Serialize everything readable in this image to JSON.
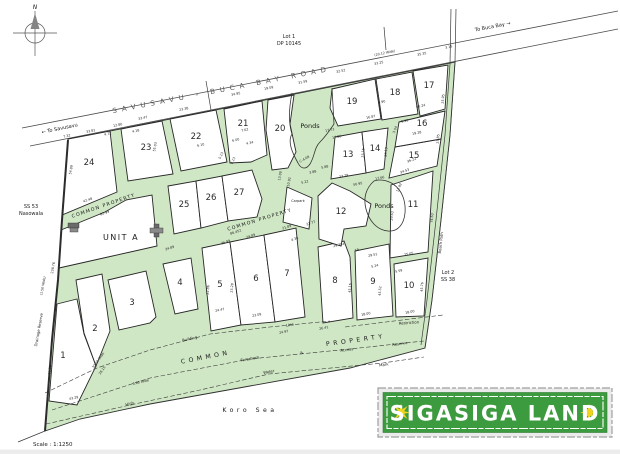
{
  "plan": {
    "title": "SIGASIGA LAND",
    "scale_label": "Scale : 1:1250",
    "north_label": "N",
    "sea_label": "Koro Sea"
  },
  "road": {
    "name": "SAVUSAVU - BUCA BAY ROAD",
    "width_note": "(20.12 Wide)",
    "to_west": "← To Savusavu",
    "to_east": "To Buca Bay →"
  },
  "adjacent": {
    "north_lot": [
      "Lot 1",
      "DP 10145"
    ],
    "west_lot": [
      "SS 53",
      "Nasowala"
    ],
    "southeast_lot": [
      "Lot 2",
      "SS 38"
    ]
  },
  "colors": {
    "land_green": "#cfe7c4",
    "logo_green": "#3d9b3f",
    "logo_star": "#f2d41c",
    "line_dark": "#222222"
  },
  "lots": [
    {
      "n": "1",
      "x": 63,
      "y": 358
    },
    {
      "n": "2",
      "x": 95,
      "y": 331
    },
    {
      "n": "3",
      "x": 132,
      "y": 305
    },
    {
      "n": "4",
      "x": 180,
      "y": 285
    },
    {
      "n": "5",
      "x": 220,
      "y": 287
    },
    {
      "n": "6",
      "x": 256,
      "y": 281
    },
    {
      "n": "7",
      "x": 287,
      "y": 276
    },
    {
      "n": "8",
      "x": 335,
      "y": 283
    },
    {
      "n": "9",
      "x": 373,
      "y": 284
    },
    {
      "n": "10",
      "x": 409,
      "y": 288
    },
    {
      "n": "11",
      "x": 413,
      "y": 207
    },
    {
      "n": "12",
      "x": 341,
      "y": 214
    },
    {
      "n": "13",
      "x": 348,
      "y": 157
    },
    {
      "n": "14",
      "x": 375,
      "y": 151
    },
    {
      "n": "15",
      "x": 414,
      "y": 158
    },
    {
      "n": "16",
      "x": 422,
      "y": 126
    },
    {
      "n": "17",
      "x": 429,
      "y": 88
    },
    {
      "n": "18",
      "x": 395,
      "y": 95
    },
    {
      "n": "19",
      "x": 352,
      "y": 104
    },
    {
      "n": "20",
      "x": 280,
      "y": 131
    },
    {
      "n": "21",
      "x": 243,
      "y": 126
    },
    {
      "n": "22",
      "x": 196,
      "y": 139
    },
    {
      "n": "23",
      "x": 146,
      "y": 150
    },
    {
      "n": "24",
      "x": 89,
      "y": 165
    },
    {
      "n": "25",
      "x": 184,
      "y": 207
    },
    {
      "n": "26",
      "x": 211,
      "y": 200
    },
    {
      "n": "27",
      "x": 239,
      "y": 195
    }
  ],
  "labels": [
    {
      "t": "SAVUSAVU - BUCA BAY ROAD",
      "x": 222,
      "y": 92,
      "r": -11,
      "c": "road"
    },
    {
      "t": "← To Savusavu",
      "x": 60,
      "y": 130,
      "r": -12,
      "c": "small"
    },
    {
      "t": "To Buca Bay →",
      "x": 493,
      "y": 28,
      "r": -11,
      "c": "small"
    },
    {
      "t": "Lot 1",
      "x": 289,
      "y": 38,
      "r": 0,
      "c": "small"
    },
    {
      "t": "DP 10145",
      "x": 289,
      "y": 45,
      "r": 0,
      "c": "small"
    },
    {
      "t": "SS 53",
      "x": 31,
      "y": 208,
      "r": 0,
      "c": "small"
    },
    {
      "t": "Nasowala",
      "x": 31,
      "y": 215,
      "r": 0,
      "c": "small"
    },
    {
      "t": "Lot 2",
      "x": 448,
      "y": 274,
      "r": 0,
      "c": "small"
    },
    {
      "t": "SS 38",
      "x": 448,
      "y": 281,
      "r": 0,
      "c": "small"
    },
    {
      "t": "UNIT A",
      "x": 121,
      "y": 240,
      "r": 0,
      "c": "unit"
    },
    {
      "t": "Ponds",
      "x": 310,
      "y": 128,
      "r": 0,
      "c": "ponds"
    },
    {
      "t": "Ponds",
      "x": 384,
      "y": 208,
      "r": 0,
      "c": "ponds"
    },
    {
      "t": "Carpark",
      "x": 298,
      "y": 202,
      "r": 0,
      "c": "micro"
    },
    {
      "t": "COMMON PROPERTY",
      "x": 104,
      "y": 207,
      "r": -19,
      "c": "cp"
    },
    {
      "t": "COMMON PROPERTY",
      "x": 260,
      "y": 221,
      "r": -17,
      "c": "cp"
    },
    {
      "t": "COMMON",
      "x": 206,
      "y": 359,
      "r": -11,
      "c": "cpband"
    },
    {
      "t": "PROPERTY",
      "x": 356,
      "y": 342,
      "r": -8,
      "c": "cpband"
    },
    {
      "t": "Building",
      "x": 190,
      "y": 340,
      "r": -13,
      "c": "tiny"
    },
    {
      "t": "Line",
      "x": 290,
      "y": 326,
      "r": -10,
      "c": "tiny"
    },
    {
      "t": "Foreshore",
      "x": 250,
      "y": 360,
      "r": -10,
      "c": "tiny"
    },
    {
      "t": "&",
      "x": 302,
      "y": 354,
      "r": -10,
      "c": "tiny"
    },
    {
      "t": "Access",
      "x": 347,
      "y": 351,
      "r": -8,
      "c": "tiny"
    },
    {
      "t": "Reserve",
      "x": 400,
      "y": 345,
      "r": -8,
      "c": "tiny"
    },
    {
      "t": "Water",
      "x": 269,
      "y": 373,
      "r": -10,
      "c": "tiny"
    },
    {
      "t": "Mark",
      "x": 384,
      "y": 366,
      "r": -8,
      "c": "tiny"
    },
    {
      "t": "High",
      "x": 130,
      "y": 405,
      "r": -14,
      "c": "tiny"
    },
    {
      "t": "Restriction",
      "x": 409,
      "y": 324,
      "r": -4,
      "c": "tiny"
    },
    {
      "t": "Beach Path",
      "x": 442,
      "y": 243,
      "r": -84,
      "c": "tiny"
    },
    {
      "t": "Drainage Reserve",
      "x": 40,
      "y": 330,
      "r": -80,
      "c": "tiny"
    },
    {
      "t": "Koro Sea",
      "x": 250,
      "y": 412,
      "r": 0,
      "c": "sea"
    },
    {
      "t": "N",
      "x": 35,
      "y": 9,
      "r": 0,
      "c": "north"
    }
  ],
  "dims": [
    {
      "t": "7.32",
      "x": 67,
      "y": 137,
      "r": -12
    },
    {
      "t": "33.81",
      "x": 91,
      "y": 132,
      "r": -12
    },
    {
      "t": "12.80",
      "x": 118,
      "y": 126,
      "r": -12
    },
    {
      "t": "33.47",
      "x": 143,
      "y": 119,
      "r": -12
    },
    {
      "t": "23.38",
      "x": 184,
      "y": 110,
      "r": -12
    },
    {
      "t": "34.95",
      "x": 236,
      "y": 95,
      "r": -12
    },
    {
      "t": "19.09",
      "x": 269,
      "y": 89,
      "r": -12
    },
    {
      "t": "31.59",
      "x": 303,
      "y": 83,
      "r": -12
    },
    {
      "t": "32.52",
      "x": 341,
      "y": 72,
      "r": -12
    },
    {
      "t": "33.25",
      "x": 379,
      "y": 64,
      "r": -12
    },
    {
      "t": "35.35",
      "x": 422,
      "y": 55,
      "r": -12
    },
    {
      "t": "3.15",
      "x": 449,
      "y": 48,
      "r": -12
    },
    {
      "t": "(20.12 Wide)",
      "x": 385,
      "y": 54,
      "r": -12
    },
    {
      "t": "4.72",
      "x": 108,
      "y": 135,
      "r": -12
    },
    {
      "t": "4.18",
      "x": 136,
      "y": 132,
      "r": -12
    },
    {
      "t": "55.03",
      "x": 156,
      "y": 147,
      "r": -80
    },
    {
      "t": "6.10",
      "x": 201,
      "y": 146,
      "r": -12
    },
    {
      "t": "5.13",
      "x": 222,
      "y": 156,
      "r": -65
    },
    {
      "t": "8.13",
      "x": 234,
      "y": 161,
      "r": -65
    },
    {
      "t": "7.62",
      "x": 245,
      "y": 131,
      "r": -12
    },
    {
      "t": "6.00",
      "x": 236,
      "y": 141,
      "r": -12
    },
    {
      "t": "4.34",
      "x": 250,
      "y": 144,
      "r": -12
    },
    {
      "t": "C-4.08",
      "x": 305,
      "y": 160,
      "r": -30
    },
    {
      "t": "3.88",
      "x": 313,
      "y": 173,
      "r": -12
    },
    {
      "t": "5.88",
      "x": 325,
      "y": 168,
      "r": -12
    },
    {
      "t": "5.22",
      "x": 305,
      "y": 183,
      "r": -12
    },
    {
      "t": "13.00",
      "x": 281,
      "y": 176,
      "r": -80
    },
    {
      "t": "10.92",
      "x": 290,
      "y": 182,
      "r": -80
    },
    {
      "t": "17.73",
      "x": 330,
      "y": 131,
      "r": -12
    },
    {
      "t": "17.86",
      "x": 337,
      "y": 138,
      "r": -12
    },
    {
      "t": "16.87",
      "x": 371,
      "y": 118,
      "r": -12
    },
    {
      "t": "4.90",
      "x": 382,
      "y": 103,
      "r": -12
    },
    {
      "t": "5.95",
      "x": 405,
      "y": 122,
      "r": -12
    },
    {
      "t": "3.04",
      "x": 396,
      "y": 130,
      "r": -70
    },
    {
      "t": "61.24",
      "x": 421,
      "y": 107,
      "r": -12
    },
    {
      "t": "19.28",
      "x": 417,
      "y": 134,
      "r": -12
    },
    {
      "t": "23.15",
      "x": 364,
      "y": 153,
      "r": -85
    },
    {
      "t": "23.19",
      "x": 387,
      "y": 152,
      "r": -85
    },
    {
      "t": "25.95",
      "x": 444,
      "y": 99,
      "r": -85
    },
    {
      "t": "23.85",
      "x": 439,
      "y": 139,
      "r": -85
    },
    {
      "t": "33.29",
      "x": 344,
      "y": 177,
      "r": -12
    },
    {
      "t": "50.95",
      "x": 358,
      "y": 185,
      "r": -12
    },
    {
      "t": "17.66",
      "x": 380,
      "y": 179,
      "r": -12
    },
    {
      "t": "12.92",
      "x": 400,
      "y": 188,
      "r": -65
    },
    {
      "t": "36.22",
      "x": 412,
      "y": 161,
      "r": -20
    },
    {
      "t": "34.53",
      "x": 405,
      "y": 172,
      "r": -20
    },
    {
      "t": "74.63",
      "x": 433,
      "y": 218,
      "r": -85
    },
    {
      "t": "29.63",
      "x": 393,
      "y": 216,
      "r": -85
    },
    {
      "t": "54.89",
      "x": 72,
      "y": 170,
      "r": -80
    },
    {
      "t": "238.76",
      "x": 54,
      "y": 268,
      "r": -80
    },
    {
      "t": "(1.50 Wide)",
      "x": 44,
      "y": 286,
      "r": -80
    },
    {
      "t": "42.48",
      "x": 88,
      "y": 201,
      "r": -19
    },
    {
      "t": "82.99",
      "x": 105,
      "y": 214,
      "r": -19
    },
    {
      "t": "34.89",
      "x": 170,
      "y": 249,
      "r": -18
    },
    {
      "t": "36.99",
      "x": 226,
      "y": 243,
      "r": -18
    },
    {
      "t": "24.89",
      "x": 251,
      "y": 237,
      "r": -18
    },
    {
      "t": "86.452",
      "x": 236,
      "y": 233,
      "r": -18
    },
    {
      "t": "21.89",
      "x": 287,
      "y": 228,
      "r": -18
    },
    {
      "t": "22.77",
      "x": 311,
      "y": 224,
      "r": -18
    },
    {
      "t": "4.38",
      "x": 295,
      "y": 240,
      "r": -18
    },
    {
      "t": "22.86",
      "x": 209,
      "y": 290,
      "r": -85
    },
    {
      "t": "23.28",
      "x": 233,
      "y": 288,
      "r": -85
    },
    {
      "t": "24.47",
      "x": 220,
      "y": 311,
      "r": -12
    },
    {
      "t": "23.09",
      "x": 257,
      "y": 316,
      "r": -12
    },
    {
      "t": "24.97",
      "x": 284,
      "y": 333,
      "r": -12
    },
    {
      "t": "26.41",
      "x": 324,
      "y": 329,
      "r": -12
    },
    {
      "t": "29.354",
      "x": 339,
      "y": 246,
      "r": -12
    },
    {
      "t": "19",
      "x": 357,
      "y": 251,
      "r": -12
    },
    {
      "t": "29.51",
      "x": 373,
      "y": 256,
      "r": -12
    },
    {
      "t": "25.05",
      "x": 409,
      "y": 255,
      "r": -12
    },
    {
      "t": "5.24",
      "x": 375,
      "y": 267,
      "r": -12
    },
    {
      "t": "5.59",
      "x": 399,
      "y": 272,
      "r": -12
    },
    {
      "t": "45.16",
      "x": 351,
      "y": 288,
      "r": -85
    },
    {
      "t": "45.52",
      "x": 381,
      "y": 291,
      "r": -85
    },
    {
      "t": "45.76",
      "x": 423,
      "y": 287,
      "r": -85
    },
    {
      "t": "18.00",
      "x": 366,
      "y": 315,
      "r": -10
    },
    {
      "t": "18.00",
      "x": 410,
      "y": 313,
      "r": -10
    },
    {
      "t": "30.00 Wide",
      "x": 99,
      "y": 361,
      "r": -55
    },
    {
      "t": "28.15",
      "x": 103,
      "y": 371,
      "r": -55
    },
    {
      "t": "70.08",
      "x": 51,
      "y": 370,
      "r": -85
    },
    {
      "t": "43.29",
      "x": 74,
      "y": 399,
      "r": -12
    },
    {
      "t": "6.00 Wide",
      "x": 141,
      "y": 383,
      "r": -14
    }
  ]
}
